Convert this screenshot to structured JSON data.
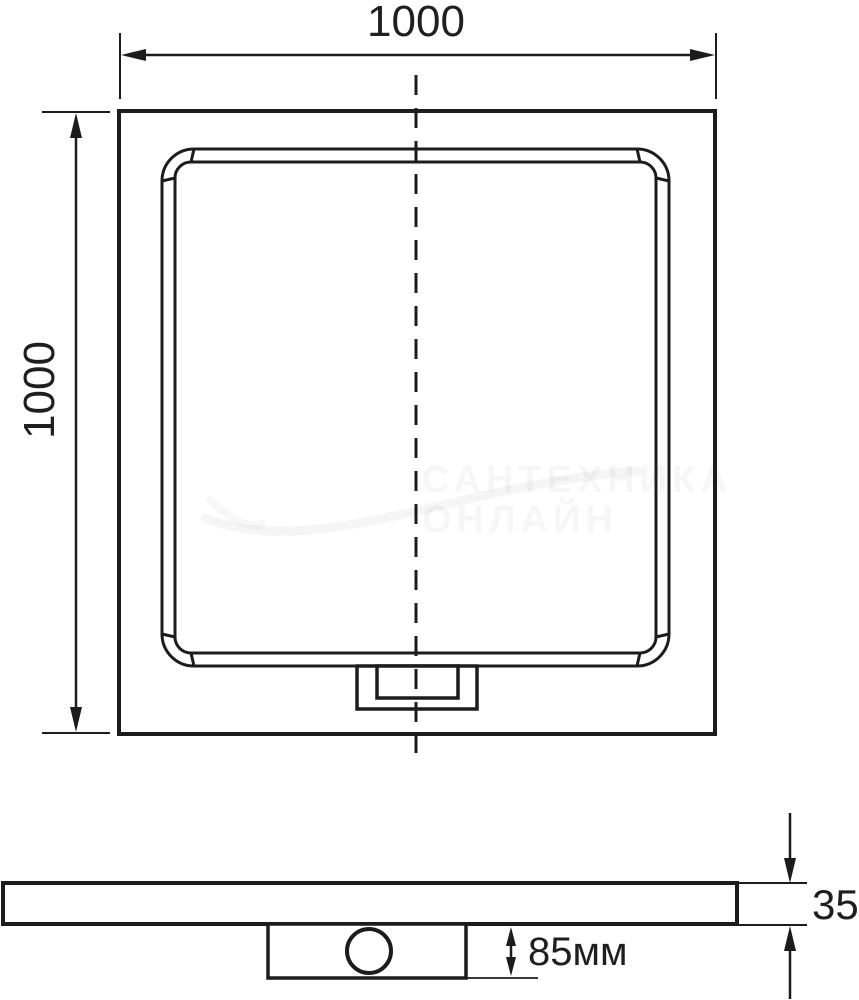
{
  "drawing": {
    "title": "square shower tray dimension drawing",
    "labels": {
      "top_width": "1000",
      "left_height": "1000",
      "side_thickness": "35",
      "drain_depth": "85мм"
    },
    "watermark": {
      "line1": "САНТЕХНИКА",
      "line2": "ОНЛАЙН"
    },
    "colors": {
      "line": "#1c1c1c",
      "background": "#ffffff",
      "watermark": "#f0f0f0"
    }
  }
}
